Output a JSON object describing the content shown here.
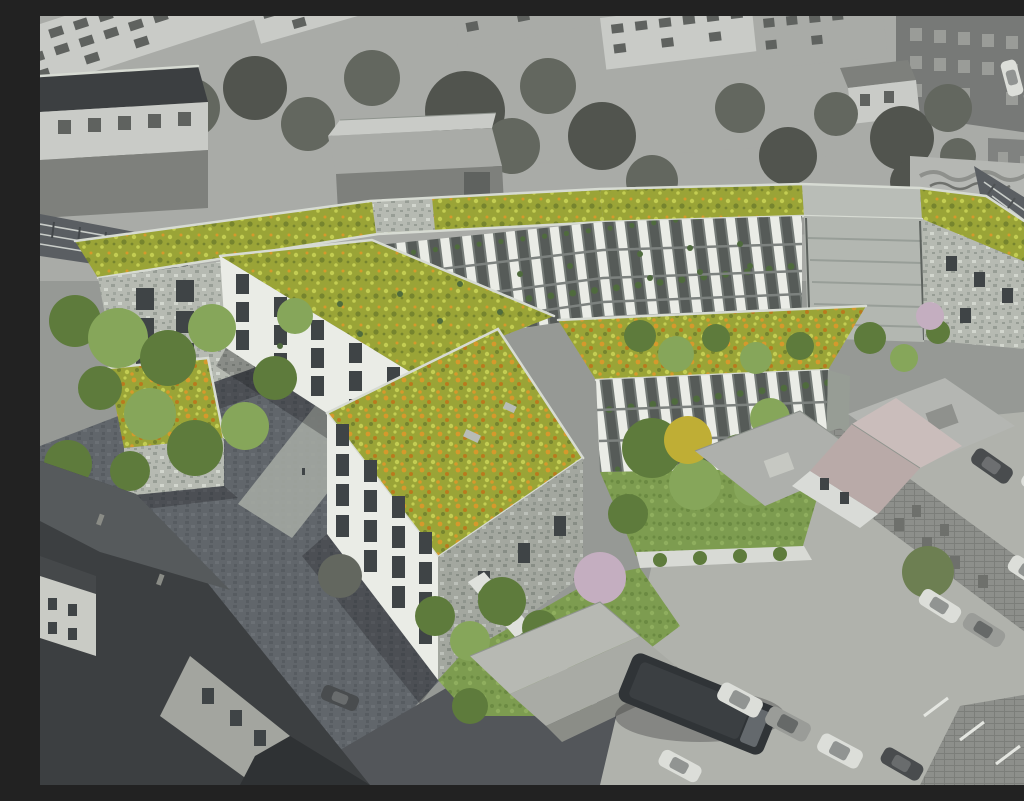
{
  "meta": {
    "title": "Aerial architectural rendering: new residential complex with wildflower green roofs, balcony facades, cobbled plaza and green courtyards, shown in color inside a desaturated greyscale city context with railway, parking lot and existing roofs",
    "style": "photomontage — colored proposal over greyscale existing surroundings",
    "visible_text": "none"
  },
  "palette": {
    "bg": "#969995",
    "city-light": "#c9cbc7",
    "city-mid": "#a9aba7",
    "city-dark": "#7e807c",
    "city-deep": "#5f625f",
    "tree-gray": "#63675f",
    "tree-gray-dark": "#51544e",
    "roof-dark": "#3c3f41",
    "asphalt": "#53565a",
    "cobble": "#61666b",
    "rail-bed": "#5a5e62",
    "facade-white": "#eaece6",
    "facade-shade": "#c6c9c3",
    "stone": "#b6bab2",
    "stone-dark": "#979d95",
    "parapet": "#d7dbd3",
    "window-dark": "#3f4446",
    "green-roof": "#9aa437",
    "green-roof-light": "#c3cd52",
    "green-roof-dark": "#76842e",
    "poppy": "#d6992c",
    "poppy-deep": "#b97a1e",
    "lawn": "#7d9c50",
    "tree-green": "#5e7b3c",
    "tree-green-light": "#86a65a",
    "tree-yellow": "#bfae35",
    "tree-olive": "#6d7f52",
    "blossom": "#c4aec0",
    "car-white": "#dcded9",
    "car-gray": "#9a9c98",
    "car-dark": "#494c4e",
    "shadow": "rgba(20,22,24,0.28)"
  },
  "scene": {
    "labels": {
      "context_city": "existing city blocks, greyscale",
      "context_trees": "existing trees, greyscale",
      "white_building": "existing flat-roof building",
      "warehouse": "existing industrial hall",
      "graffiti_wall": "wall with graffiti along railway",
      "railway_right": "railway corridor at right edge",
      "railway_left": "railway tracks at left edge",
      "complex": "proposed residential complex with green roofs",
      "north_wing": "long north wing with balcony facade and meadow roof",
      "west_block": "west block with punched-window facade",
      "center_block": "central block with poppy meadow roof",
      "court_block": "courtyard wing with balconies and meadow roof",
      "courtyard": "green courtyard with lawn and trees",
      "roof_cube": "one-storey cube with meadow roof",
      "entry_stair": "stepped entry path between wings",
      "plaza": "cobbled neighbourhood plaza",
      "garden_south": "south garden with blossom tree and vine-covered wall",
      "terrace_gardens": "terraced gardens beside the railway",
      "foreground_roofs": "existing roofs in the foreground, greyscale",
      "pink_house": "existing gabled house",
      "brick_row": "existing brick row building",
      "parking": "parking lot with parked cars, greyscale",
      "street": "street with bus",
      "bus": "bus on the street",
      "vehicles": "parked cars"
    }
  }
}
